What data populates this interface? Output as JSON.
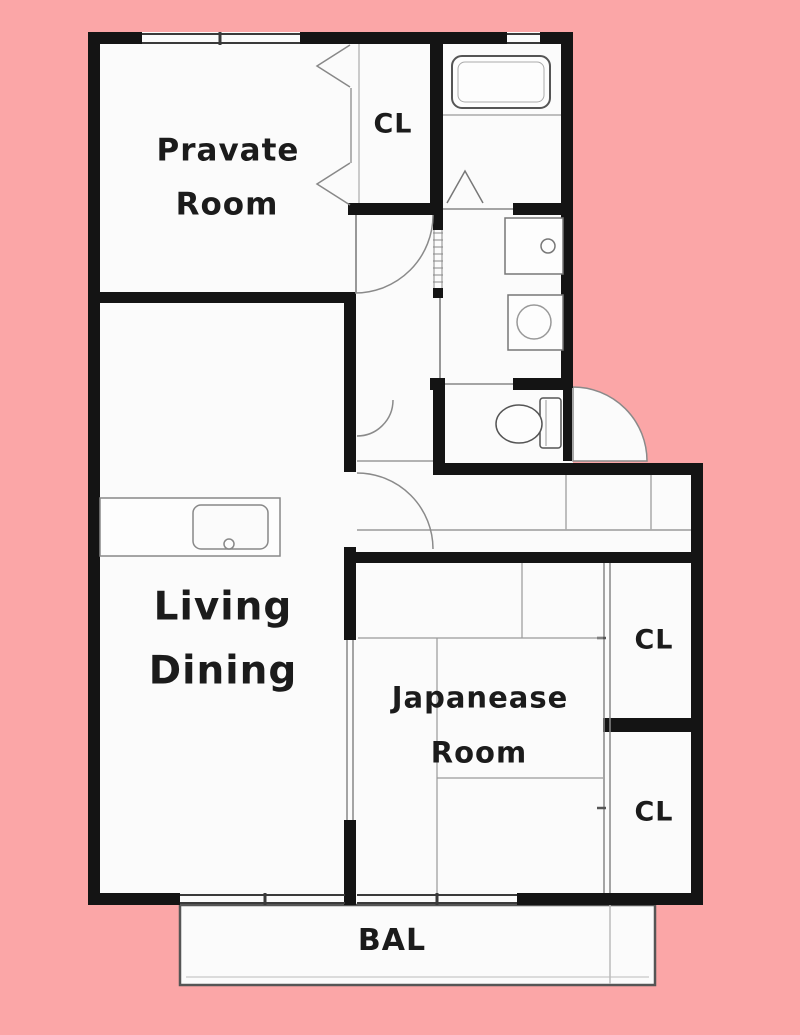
{
  "floorplan": {
    "title": "apartment-floor-plan",
    "rooms": {
      "private_room": {
        "line1": "Pravate",
        "line2": "Room"
      },
      "living_dining": {
        "line1": "Living",
        "line2": "Dining"
      },
      "japanese_room": {
        "line1": "Japanease",
        "line2": "Room"
      },
      "closet_top": {
        "label": "CL"
      },
      "closet_upper_right": {
        "label": "CL"
      },
      "closet_lower_right": {
        "label": "CL"
      },
      "balcony": {
        "label": "BAL"
      }
    },
    "fixtures": [
      "bathtub",
      "washbasin",
      "washing-machine",
      "toilet",
      "kitchen-counter",
      "kitchen-sink",
      "entry-door",
      "tatami-mats"
    ],
    "colors": {
      "background": "#FBA6A7",
      "floor": "#FBFBFB",
      "wall": "#141414",
      "thin_line": "#999999",
      "text": "#1B1B1B"
    }
  }
}
